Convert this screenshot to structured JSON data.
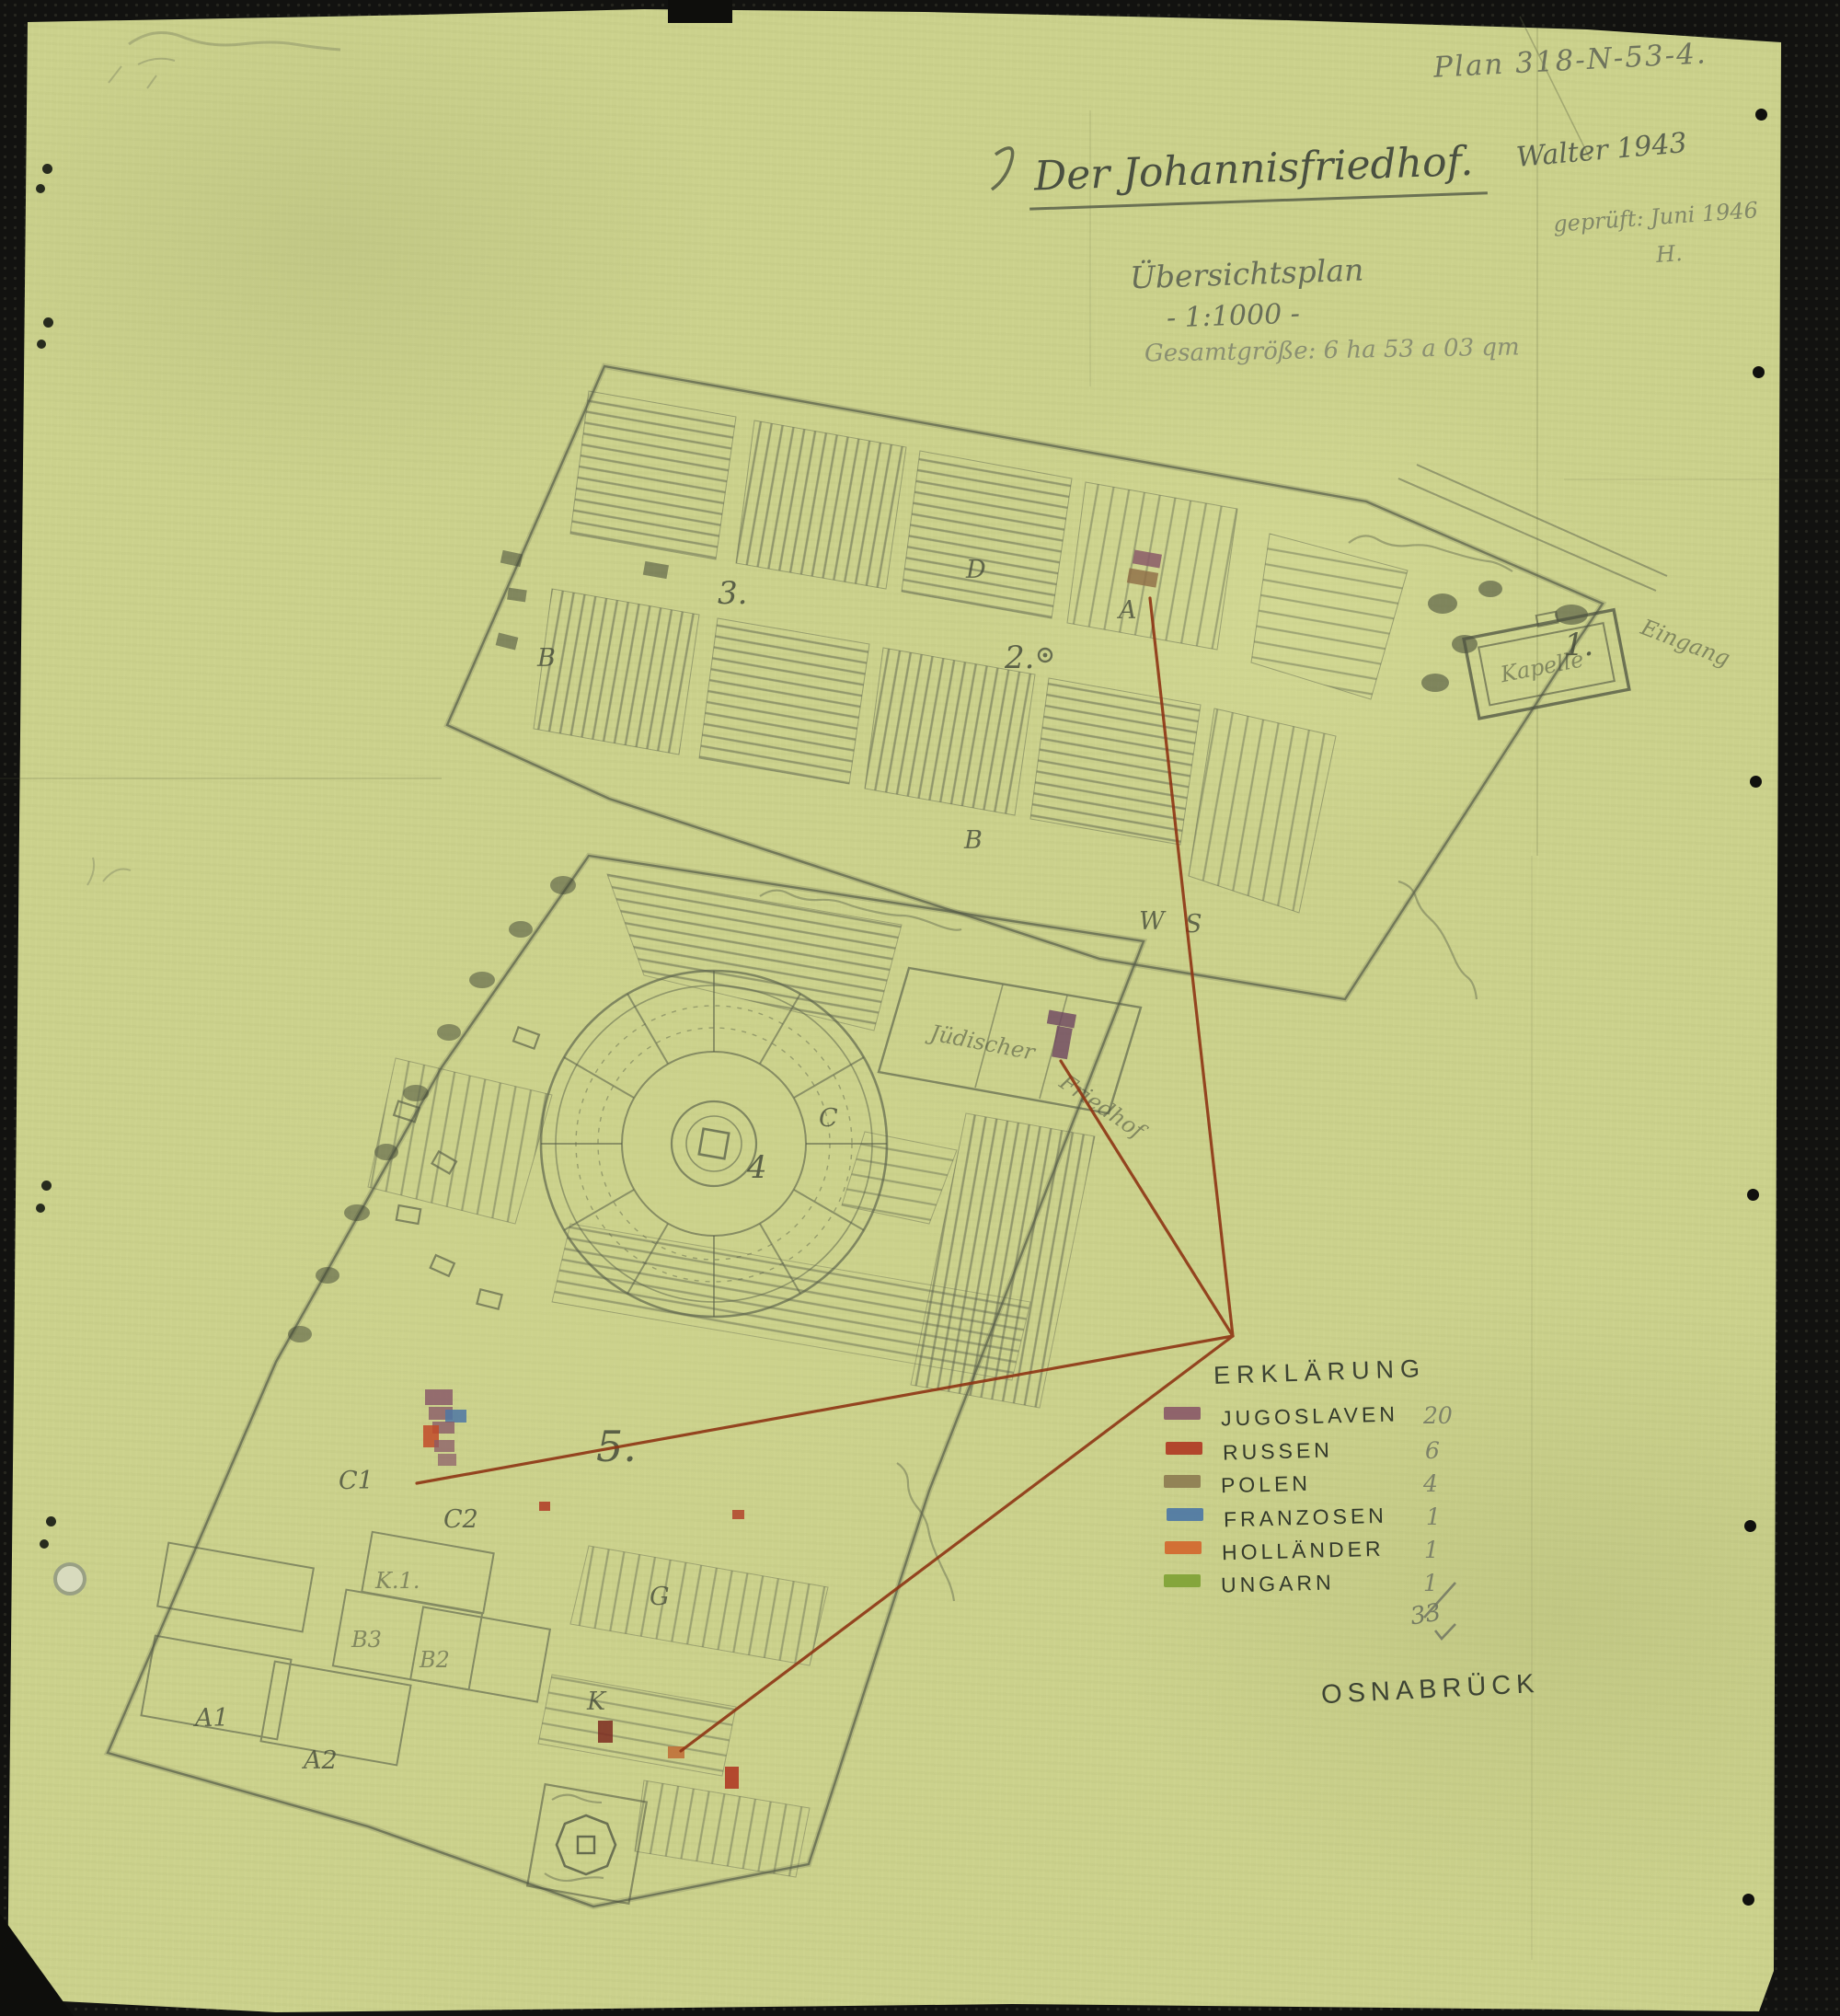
{
  "header": {
    "plan_number": "Plan 318-N-53-4.",
    "author_year": "Walter 1943",
    "checked_note": "geprüft: Juni 1946",
    "checked_initial": "H.",
    "title": "Der Johannisfriedhof.",
    "subtitle": "Übersichtsplan",
    "scale_note": "- 1:1000 -",
    "area_note": "Gesamtgröße: 6 ha 53 a 03 qm"
  },
  "legend": {
    "title": "ERKLÄRUNG",
    "entries": [
      {
        "label": "JUGOSLAVEN",
        "count": "20",
        "color": "#8a5a68"
      },
      {
        "label": "RUSSEN",
        "count": "6",
        "color": "#b03a24"
      },
      {
        "label": "POLEN",
        "count": "4",
        "color": "#8d7c51"
      },
      {
        "label": "FRANZOSEN",
        "count": "1",
        "color": "#4d77a5"
      },
      {
        "label": "HOLLÄNDER",
        "count": "1",
        "color": "#d2672e"
      },
      {
        "label": "UNGARN",
        "count": "1",
        "color": "#7fa235"
      }
    ],
    "total": "33"
  },
  "footer": {
    "city": "OSNABRÜCK"
  },
  "map": {
    "upper_labels": {
      "one": "1.",
      "two": "2.",
      "three": "3.",
      "a": "A",
      "b_left": "B",
      "b_mid": "B",
      "d": "D",
      "w": "W",
      "s": "S",
      "chapel": "Kapelle",
      "entrance": "Eingang"
    },
    "lower_labels": {
      "four": "4",
      "five": "5.",
      "c": "C",
      "c1": "C1",
      "c2": "C2",
      "g": "G",
      "k1": "K.1.",
      "b3": "B3",
      "b2": "B2",
      "a1": "A1",
      "a2": "A2",
      "k": "K",
      "jewish_line1": "Jüdischer",
      "jewish_line2": "Friedhof"
    }
  }
}
